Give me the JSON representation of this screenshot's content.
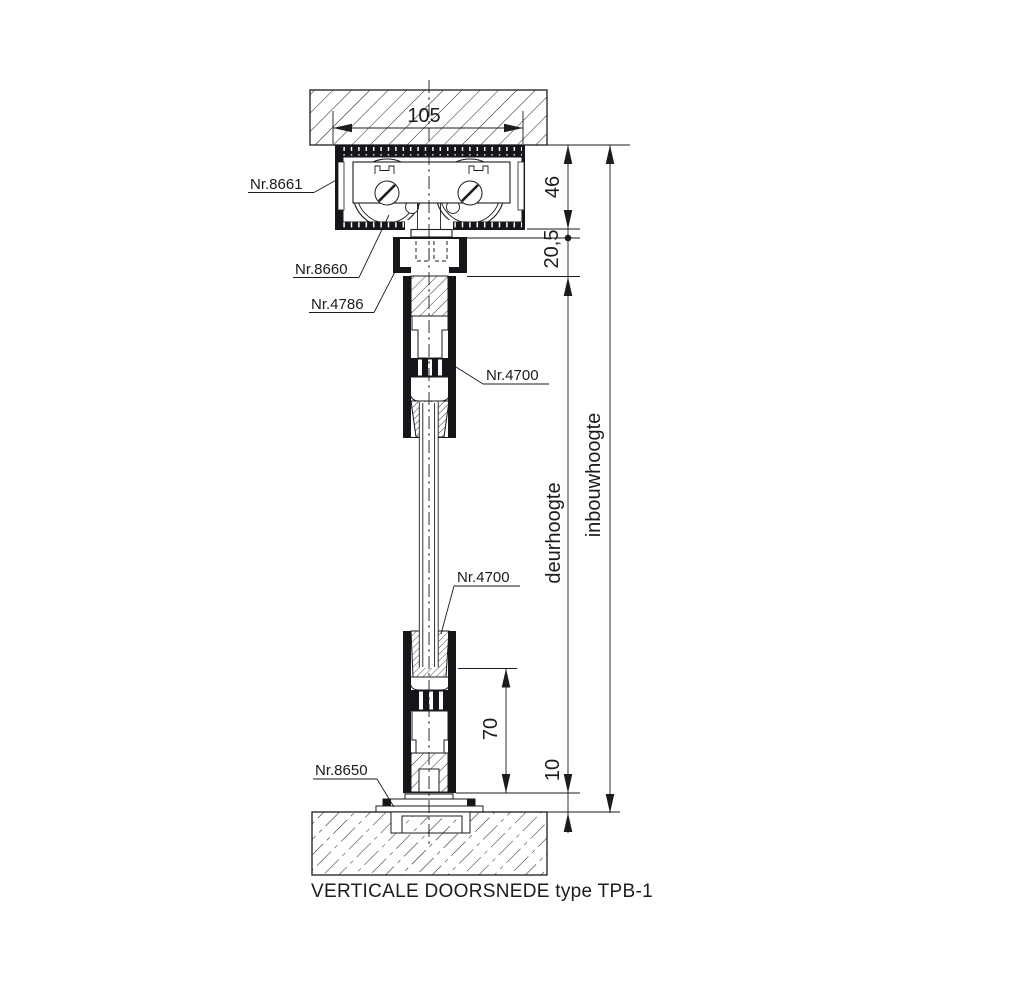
{
  "drawing": {
    "caption": "VERTICALE DOORSNEDE type TPB-1",
    "part_labels": {
      "top_track": "Nr.8661",
      "roller_trolley": "Nr.8660",
      "suspension_bracket": "Nr.4786",
      "door_rail_top": "Nr.4700",
      "door_rail_bottom": "Nr.4700",
      "floor_guide": "Nr.8650"
    },
    "dimensions": {
      "track_width": "105",
      "track_height": "46",
      "top_clearance": "20,5",
      "bottom_rail_inset": "70",
      "floor_clearance": "10",
      "door_height_label": "deurhoogte",
      "installation_height_label": "inbouwhoogte"
    },
    "colors": {
      "line": "#1b1b20",
      "background": "#ffffff"
    }
  }
}
